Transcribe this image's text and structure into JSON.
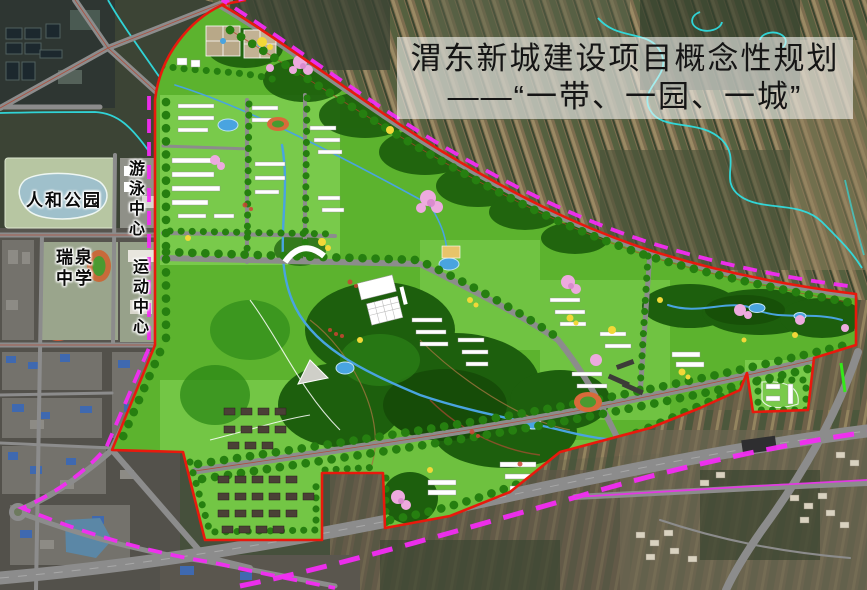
{
  "title": {
    "line1": "渭东新城建设项目概念性规划",
    "line2": "——“一带、一园、一城”"
  },
  "labels": {
    "renhe_park": "人和公园",
    "swimming_center": "游泳中心",
    "ruiquan_school": "瑞泉中学",
    "sports_center": "运动中心"
  },
  "colors": {
    "boundary": "#e8190d",
    "corridor": "#f32cf3",
    "corridor_thin": "#e23ae2",
    "highlight_green": "#35e81a",
    "plan_green": "#5cb32e",
    "tree": "#267f10",
    "forest": "#1d5f0d",
    "road": "#8c8c8c",
    "water": "#49a4e0",
    "river": "#2fe3e8",
    "label": "#0a0a0a",
    "title_text": "#151515",
    "title_bg": "rgba(255,255,255,0.56)"
  }
}
